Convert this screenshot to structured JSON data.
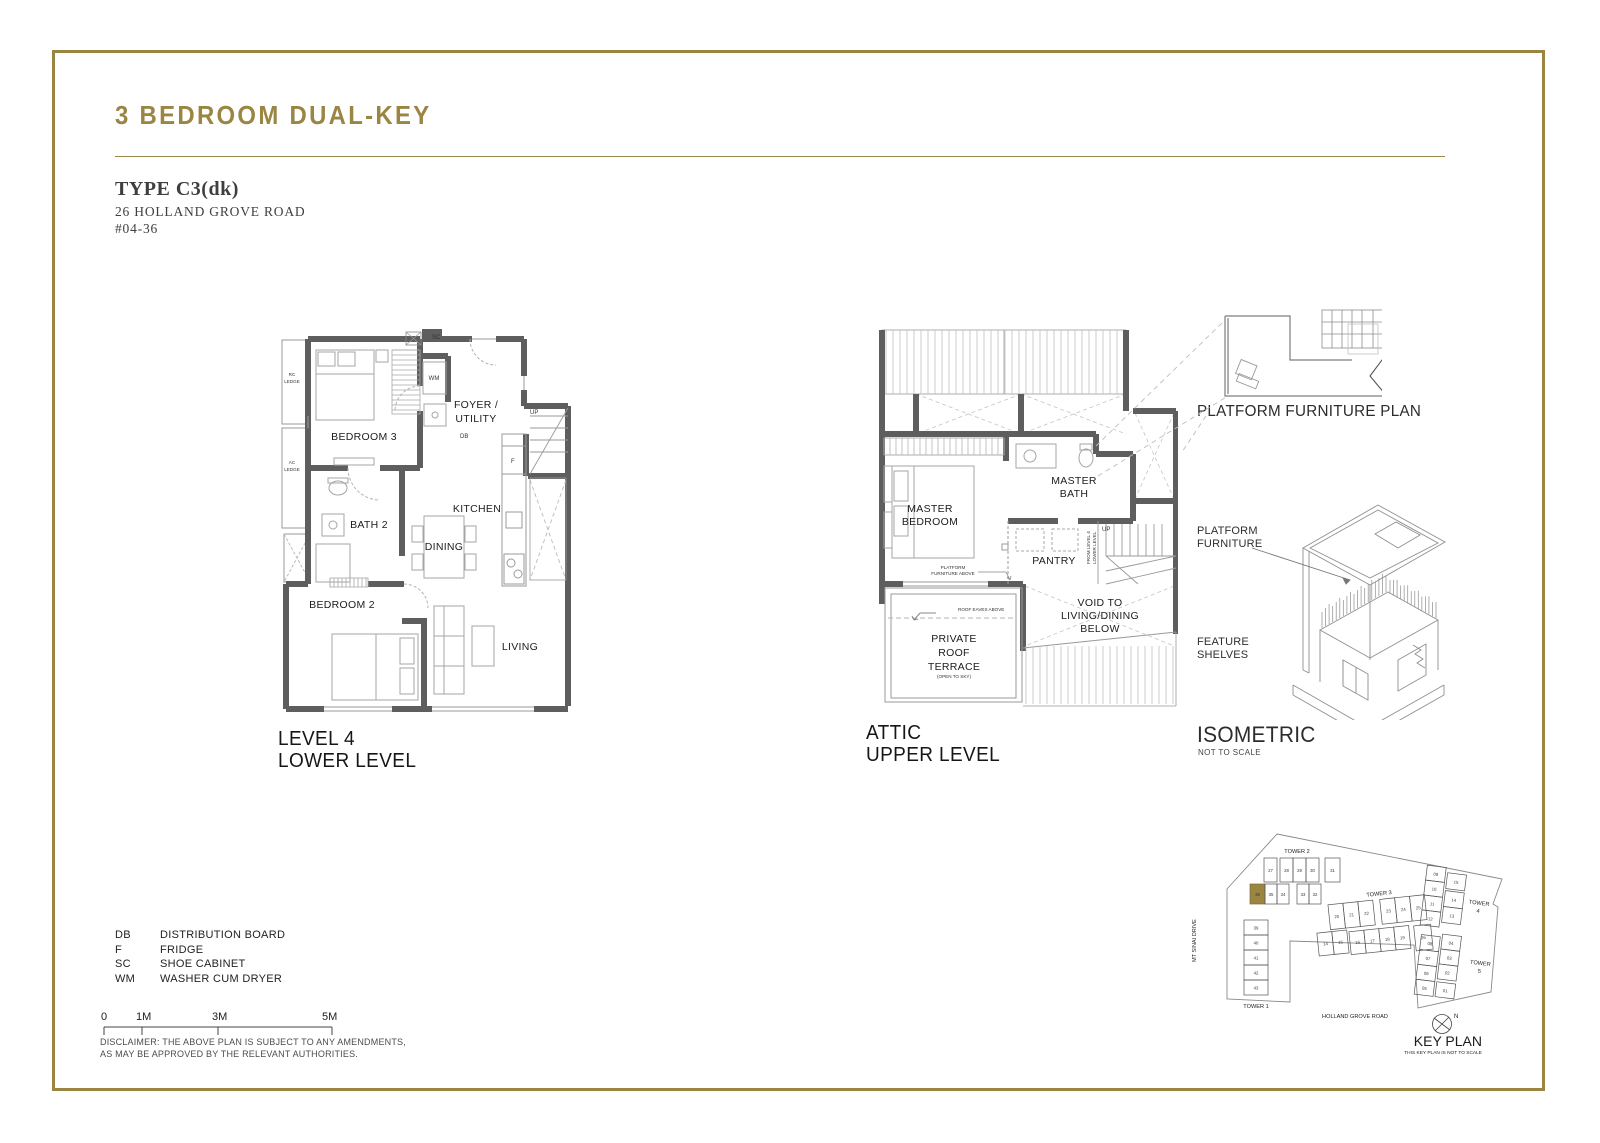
{
  "header": {
    "title": "3 BEDROOM DUAL-KEY",
    "type": "TYPE C3(dk)",
    "address": "26 HOLLAND GROVE ROAD",
    "unit": "#04-36"
  },
  "lower_plan": {
    "caption1": "LEVEL 4",
    "caption2": "LOWER LEVEL",
    "labels": {
      "rc1": "RC",
      "rc2": "LEDGE",
      "ac1": "AC",
      "ac2": "LEDGE",
      "bedroom3": "BEDROOM 3",
      "bath2": "BATH 2",
      "foyer1": "FOYER /",
      "foyer2": "UTILITY",
      "kitchen": "KITCHEN",
      "dining": "DINING",
      "bedroom2": "BEDROOM 2",
      "living": "LIVING",
      "wm": "WM",
      "sc": "SC",
      "db": "DB",
      "f": "F",
      "up": "UP"
    }
  },
  "attic_plan": {
    "caption1": "ATTIC",
    "caption2": "UPPER LEVEL",
    "labels": {
      "mb1": "MASTER",
      "mb2": "BEDROOM",
      "bath1": "MASTER",
      "bath2": "BATH",
      "pantry": "PANTRY",
      "up": "UP",
      "pfa1": "PLATFORM",
      "pfa2": "FURNITURE ABOVE",
      "fl1": "FROM LEVEL 4",
      "fl2": "LOWER LEVEL",
      "eaves": "ROOF EAVES ABOVE",
      "t1": "PRIVATE",
      "t2": "ROOF",
      "t3": "TERRACE",
      "t4": "(OPEN TO SKY)",
      "v1": "VOID TO",
      "v2": "LIVING/DINING",
      "v3": "BELOW"
    }
  },
  "platform_plan": {
    "title": "PLATFORM FURNITURE PLAN"
  },
  "isometric": {
    "pf1": "PLATFORM",
    "pf2": "FURNITURE",
    "fs1": "FEATURE",
    "fs2": "SHELVES",
    "title": "ISOMETRIC",
    "subtitle": "NOT TO SCALE"
  },
  "legend": {
    "items": [
      {
        "abbr": "DB",
        "desc": "DISTRIBUTION BOARD"
      },
      {
        "abbr": "F",
        "desc": "FRIDGE"
      },
      {
        "abbr": "SC",
        "desc": "SHOE CABINET"
      },
      {
        "abbr": "WM",
        "desc": "WASHER CUM DRYER"
      }
    ]
  },
  "scalebar": {
    "t0": "0",
    "t1": "1M",
    "t2": "3M",
    "t3": "5M"
  },
  "disclaimer": {
    "line1": "DISCLAIMER: THE ABOVE PLAN IS SUBJECT TO ANY AMENDMENTS,",
    "line2": "AS MAY BE APPROVED BY THE RELEVANT AUTHORITIES."
  },
  "keyplan": {
    "title": "KEY PLAN",
    "subtitle": "THIS KEY PLAN IS NOT TO SCALE",
    "north": "N",
    "roads": {
      "left": "MT SINAI DRIVE",
      "bottom": "HOLLAND GROVE ROAD"
    },
    "towers": {
      "tower1": {
        "label": "TOWER 1",
        "units": [
          "39",
          "40",
          "41",
          "42",
          "43"
        ]
      },
      "tower2": {
        "label": "TOWER 2",
        "row1": [
          "27",
          "28",
          "29",
          "30",
          "31"
        ],
        "row2": [
          "36",
          "35",
          "34",
          "33",
          "32"
        ],
        "highlight": "36"
      },
      "tower3": {
        "label": "TOWER 3",
        "row1": [
          "20",
          "21",
          "22",
          "23",
          "24",
          "25"
        ],
        "row2": [
          "14",
          "15",
          "16",
          "17",
          "18",
          "19",
          "26"
        ]
      },
      "tower4": {
        "label1": "TOWER",
        "label2": "4",
        "col1": [
          "09",
          "10",
          "11",
          "12"
        ],
        "col2": [
          "15",
          "14",
          "13"
        ]
      },
      "tower5": {
        "label1": "TOWER",
        "label2": "5",
        "col1": [
          "08",
          "07",
          "06",
          "05"
        ],
        "col2": [
          "04",
          "03",
          "02",
          "01"
        ]
      }
    }
  }
}
